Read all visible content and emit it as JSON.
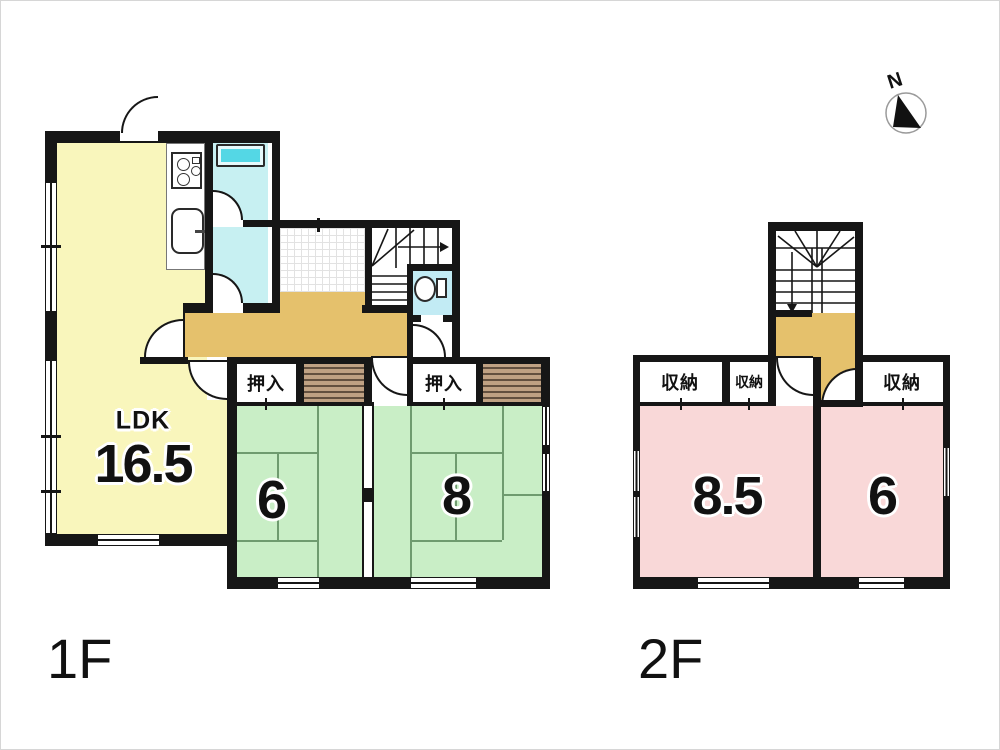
{
  "compass": {
    "label": "N"
  },
  "floors": {
    "f1": {
      "label": "1F",
      "ldk_name": "LDK",
      "ldk_size": "16.5",
      "tatami6_size": "6",
      "tatami8_size": "8",
      "closet_left": "押入",
      "closet_right": "押入"
    },
    "f2": {
      "label": "2F",
      "room_left_size": "8.5",
      "room_right_size": "6",
      "closet1": "収納",
      "closet2": "収納",
      "closet3": "収納"
    }
  },
  "colors": {
    "ldk_yellow": "#f9f6bc",
    "tatami_green": "#c9eec6",
    "room_pink": "#f9d8d8",
    "hall_tan": "#e5c16c",
    "bath_cyan": "#c7f0f2",
    "bathtub_cyan": "#54d7e5",
    "toilet_cyan": "#c2ebf4",
    "wall": "#161616"
  }
}
